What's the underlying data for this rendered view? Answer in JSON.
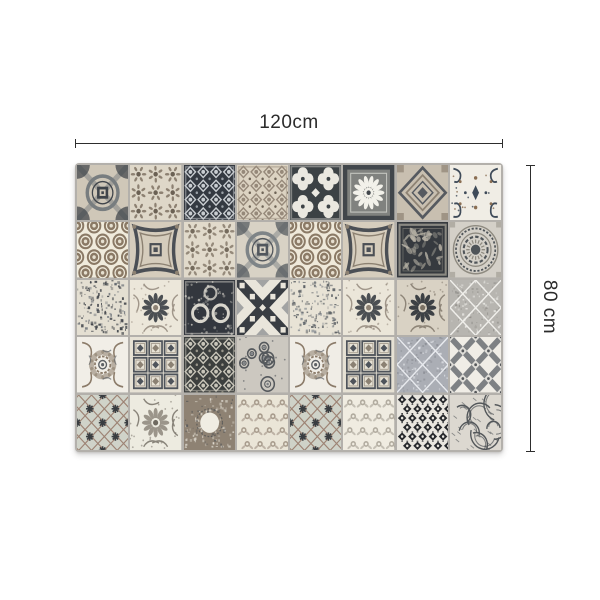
{
  "figure": {
    "type": "product-dimension-diagram",
    "background": "#ffffff",
    "annotation_color": "#2d2d2d",
    "width_label": "120cm",
    "height_label": "80 cm"
  },
  "product": {
    "description": "patchwork vintage tile mat",
    "grout_color": "#b3b0ab",
    "grid": {
      "columns": 8,
      "rows": 5
    },
    "tiles": [
      {
        "type": "medallion",
        "bg": "#cfc7b8",
        "fg": "#787d7f",
        "ac": "#3f444a"
      },
      {
        "type": "rosettes",
        "bg": "#ded7c8",
        "fg": "#8d8172",
        "ac": "#6b6154"
      },
      {
        "type": "damask",
        "bg": "#343941",
        "fg": "#c9cdd1",
        "ac": "#9aa0a6"
      },
      {
        "type": "damask",
        "bg": "#dcd3c2",
        "fg": "#96897a",
        "ac": "#6e6457"
      },
      {
        "type": "quatrefoil",
        "bg": "#3c4245",
        "fg": "#eae8e0",
        "ac": "#c8c6bd"
      },
      {
        "type": "dahlia",
        "bg": "#80827f",
        "fg": "#f2f1ea",
        "ac": "#41464b"
      },
      {
        "type": "nested",
        "bg": "#c8bfb0",
        "fg": "#565a60",
        "ac": "#8d8273"
      },
      {
        "type": "flourish",
        "bg": "#f0ede5",
        "fg": "#3f4b59",
        "ac": "#8a6e52"
      },
      {
        "type": "coins",
        "bg": "#f0ebdc",
        "fg": "#8a7965",
        "ac": "#5d5347"
      },
      {
        "type": "curved",
        "bg": "#d5ccbc",
        "fg": "#4b4f55",
        "ac": "#8c8172"
      },
      {
        "type": "rosettes",
        "bg": "#e1dacb",
        "fg": "#958a7b",
        "ac": "#756b5d"
      },
      {
        "type": "medallion",
        "bg": "#d8d2c5",
        "fg": "#7e8487",
        "ac": "#52575d"
      },
      {
        "type": "coins",
        "bg": "#efe9da",
        "fg": "#8b7a66",
        "ac": "#5d5347"
      },
      {
        "type": "curved",
        "bg": "#d6cdbd",
        "fg": "#4b4f55",
        "ac": "#8c8172"
      },
      {
        "type": "tree",
        "bg": "#363a3f",
        "fg": "#b8b3a6",
        "ac": "#8e8a7e"
      },
      {
        "type": "mandala",
        "bg": "#d4d0c8",
        "fg": "#4f5458",
        "ac": "#8e8a80"
      },
      {
        "type": "noise",
        "bg": "#e4dfd2",
        "fg": "#3e4248",
        "ac": "#6f747a"
      },
      {
        "type": "sunflower",
        "bg": "#ece7da",
        "fg": "#4b4f53",
        "ac": "#8d8275"
      },
      {
        "type": "rings",
        "bg": "#33373e",
        "fg": "#d9d6cd",
        "ac": "#a7a399"
      },
      {
        "type": "xcheck",
        "bg": "#e9e5db",
        "fg": "#393d43",
        "ac": "#73777d"
      },
      {
        "type": "noise",
        "bg": "#e8e3d6",
        "fg": "#575c61",
        "ac": "#8a8f94"
      },
      {
        "type": "sunflower",
        "bg": "#ebe6d9",
        "fg": "#4b4f53",
        "ac": "#8d8275"
      },
      {
        "type": "sunflower",
        "bg": "#d9d2c4",
        "fg": "#3d4145",
        "ac": "#7b7265"
      },
      {
        "type": "sdiamond",
        "bg": "#b7b5b0",
        "fg": "#f0efeb",
        "ac": "#8e8c87"
      },
      {
        "type": "rose",
        "bg": "#f1eee7",
        "fg": "#8b7b69",
        "ac": "#5d6165"
      },
      {
        "type": "gems",
        "bg": "#e7e2d5",
        "fg": "#4f545b",
        "ac": "#8b8173"
      },
      {
        "type": "damask",
        "bg": "#3c3f3e",
        "fg": "#c8c5b9",
        "ac": "#98958a"
      },
      {
        "type": "paisley",
        "bg": "#ccc8c0",
        "fg": "#55595d",
        "ac": "#7e8286"
      },
      {
        "type": "rose",
        "bg": "#f0ede6",
        "fg": "#8b7b69",
        "ac": "#5d6165"
      },
      {
        "type": "gems",
        "bg": "#e6e1d4",
        "fg": "#4f545b",
        "ac": "#8b8173"
      },
      {
        "type": "sdiamond",
        "bg": "#abaeb5",
        "fg": "#e8eaee",
        "ac": "#84878e"
      },
      {
        "type": "trellis",
        "bg": "#f0ede6",
        "fg": "#7e8184",
        "ac": "#55585b"
      },
      {
        "type": "snow",
        "bg": "#d0d3c9",
        "fg": "#9d8374",
        "ac": "#393d41"
      },
      {
        "type": "sunflower",
        "bg": "#edebe0",
        "fg": "#9b958a",
        "ac": "#6f6a60"
      },
      {
        "type": "ring",
        "bg": "#8e8273",
        "fg": "#f0ede3",
        "ac": "#4d5053"
      },
      {
        "type": "vintage",
        "bg": "#eae5d7",
        "fg": "#97897b",
        "ac": "#6e6357"
      },
      {
        "type": "snow",
        "bg": "#cfd2c8",
        "fg": "#9d8374",
        "ac": "#393d41"
      },
      {
        "type": "vintage",
        "bg": "#f0ece1",
        "fg": "#a19b8f",
        "ac": "#78726b"
      },
      {
        "type": "ogee",
        "bg": "#e9e6df",
        "fg": "#27292d",
        "ac": "#5a5d61"
      },
      {
        "type": "feather",
        "bg": "#dcd8d0",
        "fg": "#53575a",
        "ac": "#83878a"
      }
    ]
  }
}
